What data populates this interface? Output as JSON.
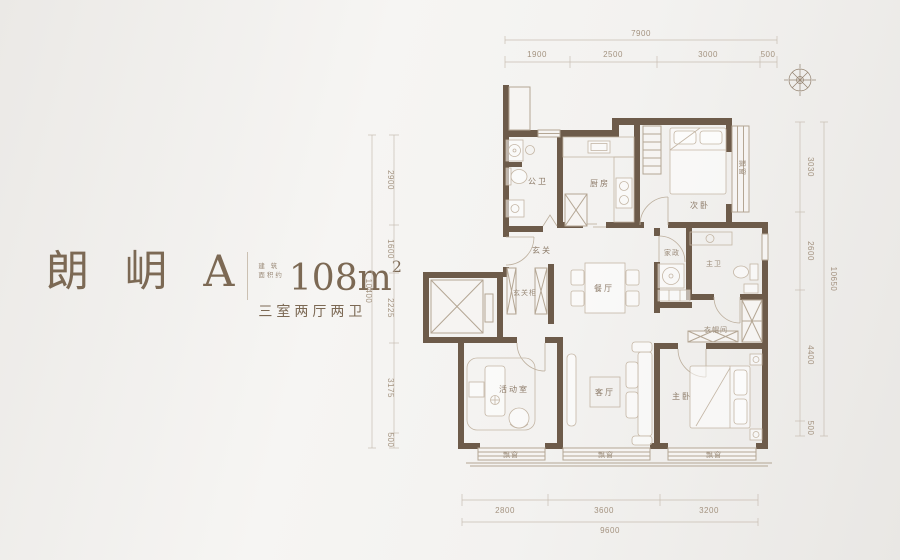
{
  "header": {
    "name": "朗 岄 A",
    "area_prefix_l1": "建 筑",
    "area_prefix_l2": "面积约",
    "area_value": "108m",
    "area_sup": "2",
    "layout": "三室两厅两卫"
  },
  "dims": {
    "top": {
      "total": "7900",
      "segs": [
        "1900",
        "2500",
        "3000",
        "500"
      ]
    },
    "left": {
      "total": "10400",
      "segs": [
        "2900",
        "1600",
        "2225",
        "3175",
        "500"
      ]
    },
    "right": {
      "total": "10650",
      "segs": [
        "3030",
        "2600",
        "4400",
        "500"
      ]
    },
    "bottom": {
      "total": "9600",
      "segs": [
        "2800",
        "3600",
        "3200"
      ]
    }
  },
  "rooms": {
    "bath": "公卫",
    "kitchen": "厨房",
    "bed2": "次卧",
    "entry": "玄关",
    "entry_cab": "玄关柜",
    "dining": "餐厅",
    "laundry": "家政",
    "mbath": "主卫",
    "cloak": "衣帽间",
    "activity": "活动室",
    "living": "客厅",
    "master": "主卧",
    "bay": "飘窗"
  },
  "colors": {
    "wall": "#6d5b4a",
    "line": "#b4a694",
    "label": "#8d7b69",
    "dim": "#a3927f",
    "title": "#7c6954"
  }
}
